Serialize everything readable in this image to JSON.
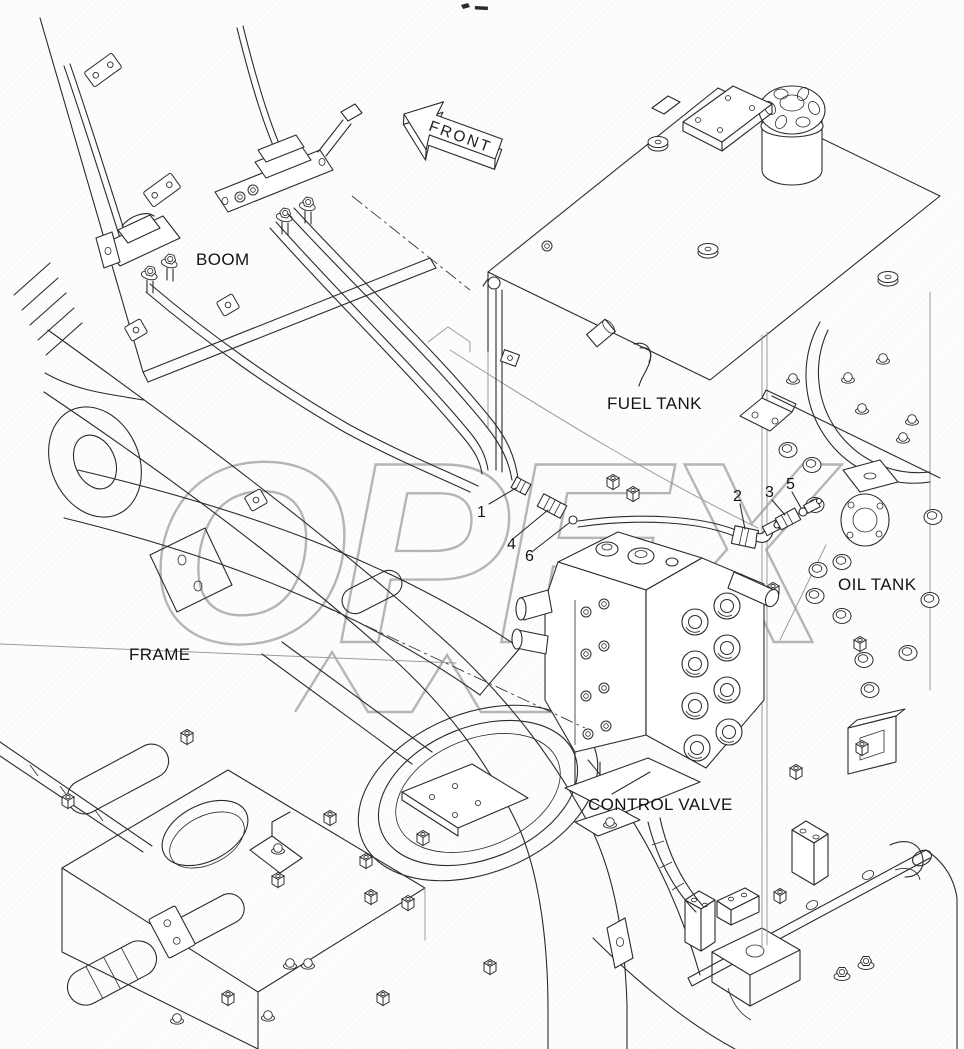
{
  "front_arrow": {
    "label": "FRONT"
  },
  "labels": {
    "boom": "BOOM",
    "fuel_tank": "FUEL TANK",
    "oil_tank": "OIL TANK",
    "frame": "FRAME",
    "control_valve": "CONTROL VALVE"
  },
  "part_callouts": [
    {
      "number": "1"
    },
    {
      "number": "2"
    },
    {
      "number": "3"
    },
    {
      "number": "4"
    },
    {
      "number": "5"
    },
    {
      "number": "6"
    }
  ],
  "watermark": {
    "text": "OPEX",
    "color": "#b5b5b5"
  },
  "colors": {
    "line": "#2b2b2b",
    "hidden_line": "#9b9b9b",
    "background": "#fcfcfc",
    "label_text": "#141414"
  }
}
